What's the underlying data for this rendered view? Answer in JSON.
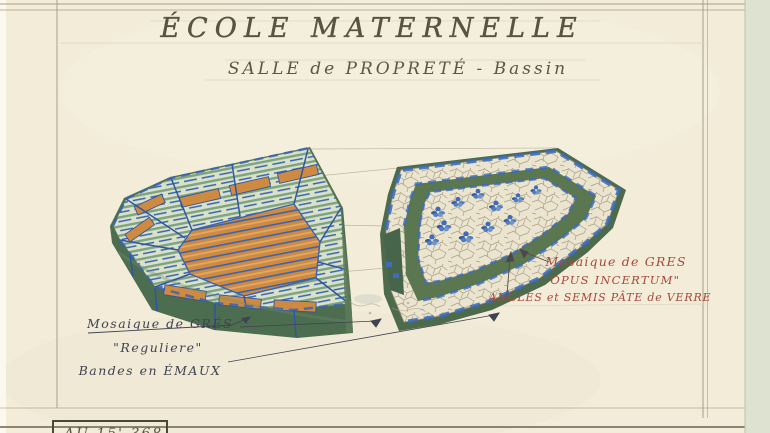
{
  "sheet": {
    "title": "ÉCOLE MATERNELLE",
    "subtitle": "SALLE de PROPRETÉ - Bassin",
    "stamp": "AU 15' 368"
  },
  "annotations": {
    "right": {
      "line1": "Mosaique de GRES",
      "line2": "\"OPUS INCERTUM\"",
      "line3": "ANGLES et SEMIS PÂTE de VERRE"
    },
    "left": {
      "line1": "Mosaique de GRÉS",
      "line2": "\"Reguliere\"",
      "line3": "Bandes en ÉMAUX"
    }
  },
  "colors": {
    "paper": "#f2ecd9",
    "frame_line": "#a79e87",
    "title_ink": "#5a5342",
    "subtitle_ink": "#5e554a",
    "left_note_ink": "#3e4352",
    "right_note_ink": "#a8493c",
    "mosaic_green_dark": "#4d6d50",
    "mosaic_green_light": "#7da37f",
    "mosaic_blue": "#3a63b0",
    "mosaic_orange": "#cf8a42",
    "mosaic_white": "#ebe4cf",
    "scan_strip": "#dde3d0"
  }
}
